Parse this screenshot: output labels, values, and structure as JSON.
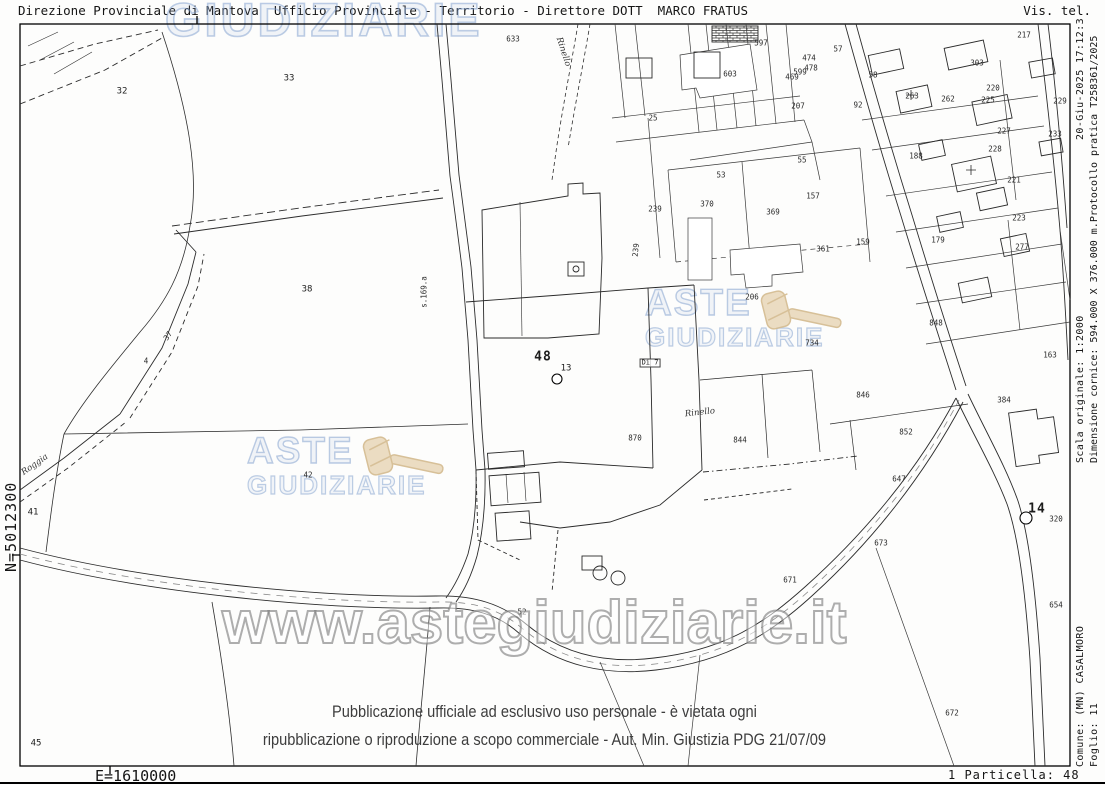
{
  "header": {
    "left": "Direzione Provinciale di Mantova  Ufficio Provinciale - Territorio - Direttore DOTT  MARCO FRATUS",
    "right": "Vis. tel."
  },
  "margins": {
    "north_coord": "N=5012300",
    "east_coord": "E=1610000",
    "particella": "1 Particella: 48",
    "timestamp": "20-Giu-2025 17:12:3",
    "scala": "Scala originale: 1:2000",
    "dimensione_protocollo": "Dimensione cornice: 594.000 X 376.000 m.Protocollo pratica T258361/2025",
    "comune": "Comune: (MN) CASALMORO",
    "foglio": "Foglio: 11"
  },
  "watermarks": {
    "top_word": "GIUDIZIARIE",
    "logo_line1": "ASTE",
    "logo_line2": "GIUDIZIARIE",
    "url": "www.astegiudiziarie.it",
    "disclaimer_line1": "Pubblicazione ufficiale ad esclusivo uso personale - è vietata ogni",
    "disclaimer_line2": "ripubblicazione o riproduzione a scopo commerciale - Aut. Min. Giustizia PDG 21/07/09",
    "brand_blue": "#80a0cd",
    "gavel_beige": "#e8d7b8"
  },
  "map": {
    "subject_parcel": "48",
    "fiducial_points": [
      "13",
      "14"
    ],
    "labels": [
      {
        "t": "32",
        "x": 122,
        "y": 92
      },
      {
        "t": "33",
        "x": 289,
        "y": 79
      },
      {
        "t": "38",
        "x": 307,
        "y": 290
      },
      {
        "t": "37",
        "x": 168,
        "y": 336,
        "r": -55,
        "s": "sm"
      },
      {
        "t": "4",
        "x": 146,
        "y": 361,
        "s": "sm"
      },
      {
        "t": "41",
        "x": 33,
        "y": 513
      },
      {
        "t": "42",
        "x": 308,
        "y": 475,
        "s": "sm"
      },
      {
        "t": "45",
        "x": 36,
        "y": 744
      },
      {
        "t": "52",
        "x": 522,
        "y": 612,
        "s": "sm"
      },
      {
        "t": "Roggia",
        "x": 35,
        "y": 465,
        "r": -35,
        "s": "it"
      },
      {
        "t": "s.169.a",
        "x": 424,
        "y": 292,
        "r": -90,
        "s": "sm"
      },
      {
        "t": "Rinello",
        "x": 563,
        "y": 52,
        "r": 72,
        "s": "it"
      },
      {
        "t": "633",
        "x": 513,
        "y": 39,
        "s": "sm"
      },
      {
        "t": "48",
        "x": 543,
        "y": 357,
        "s": "lg"
      },
      {
        "t": "13",
        "x": 566,
        "y": 369
      },
      {
        "t": "Di 7",
        "x": 650,
        "y": 363,
        "s": "bx"
      },
      {
        "t": "Rinello",
        "x": 700,
        "y": 413,
        "r": -6,
        "s": "it"
      },
      {
        "t": "239",
        "x": 655,
        "y": 209,
        "s": "sm"
      },
      {
        "t": "239",
        "x": 636,
        "y": 250,
        "r": -85,
        "s": "sm"
      },
      {
        "t": "370",
        "x": 707,
        "y": 204,
        "s": "sm"
      },
      {
        "t": "369",
        "x": 773,
        "y": 212,
        "s": "sm"
      },
      {
        "t": "206",
        "x": 752,
        "y": 297,
        "s": "sm"
      },
      {
        "t": "361",
        "x": 823,
        "y": 249,
        "s": "sm"
      },
      {
        "t": "734",
        "x": 812,
        "y": 343,
        "s": "sm"
      },
      {
        "t": "157",
        "x": 813,
        "y": 196,
        "s": "sm"
      },
      {
        "t": "159",
        "x": 863,
        "y": 242,
        "s": "sm"
      },
      {
        "t": "179",
        "x": 938,
        "y": 240,
        "s": "sm"
      },
      {
        "t": "870",
        "x": 635,
        "y": 438,
        "s": "sm"
      },
      {
        "t": "844",
        "x": 740,
        "y": 440,
        "s": "sm"
      },
      {
        "t": "846",
        "x": 863,
        "y": 395,
        "s": "sm"
      },
      {
        "t": "852",
        "x": 906,
        "y": 432,
        "s": "sm"
      },
      {
        "t": "647",
        "x": 899,
        "y": 479,
        "s": "sm"
      },
      {
        "t": "673",
        "x": 881,
        "y": 543,
        "s": "sm"
      },
      {
        "t": "671",
        "x": 790,
        "y": 580,
        "s": "sm"
      },
      {
        "t": "672",
        "x": 952,
        "y": 713,
        "s": "sm"
      },
      {
        "t": "654",
        "x": 1056,
        "y": 605,
        "s": "sm"
      },
      {
        "t": "384",
        "x": 1004,
        "y": 400,
        "s": "sm"
      },
      {
        "t": "14",
        "x": 1037,
        "y": 509,
        "s": "lg"
      },
      {
        "t": "320",
        "x": 1056,
        "y": 519,
        "s": "sm"
      },
      {
        "t": "163",
        "x": 1050,
        "y": 355,
        "s": "sm"
      },
      {
        "t": "848",
        "x": 936,
        "y": 323,
        "s": "sm"
      },
      {
        "t": "25",
        "x": 653,
        "y": 118,
        "s": "sm"
      },
      {
        "t": "53",
        "x": 721,
        "y": 175,
        "s": "sm"
      },
      {
        "t": "55",
        "x": 802,
        "y": 160,
        "s": "sm"
      },
      {
        "t": "57",
        "x": 838,
        "y": 49,
        "s": "sm"
      },
      {
        "t": "58",
        "x": 873,
        "y": 75,
        "s": "sm"
      },
      {
        "t": "92",
        "x": 858,
        "y": 105,
        "s": "sm"
      },
      {
        "t": "263",
        "x": 912,
        "y": 96,
        "s": "sm"
      },
      {
        "t": "262",
        "x": 948,
        "y": 99,
        "s": "sm"
      },
      {
        "t": "188",
        "x": 916,
        "y": 156,
        "s": "sm"
      },
      {
        "t": "228",
        "x": 995,
        "y": 149,
        "s": "sm"
      },
      {
        "t": "225",
        "x": 988,
        "y": 100,
        "s": "sm"
      },
      {
        "t": "220",
        "x": 993,
        "y": 88,
        "s": "sm"
      },
      {
        "t": "303",
        "x": 977,
        "y": 63,
        "s": "sm"
      },
      {
        "t": "207",
        "x": 798,
        "y": 106,
        "s": "sm"
      },
      {
        "t": "597",
        "x": 761,
        "y": 43,
        "s": "sm"
      },
      {
        "t": "599",
        "x": 800,
        "y": 72,
        "s": "sm"
      },
      {
        "t": "474",
        "x": 809,
        "y": 58,
        "s": "sm"
      },
      {
        "t": "478",
        "x": 811,
        "y": 68,
        "s": "sm"
      },
      {
        "t": "469",
        "x": 792,
        "y": 77,
        "s": "sm"
      },
      {
        "t": "603",
        "x": 730,
        "y": 74,
        "s": "sm"
      },
      {
        "t": "217",
        "x": 1024,
        "y": 35,
        "s": "sm"
      },
      {
        "t": "229",
        "x": 1060,
        "y": 101,
        "s": "sm"
      },
      {
        "t": "227",
        "x": 1004,
        "y": 131,
        "s": "sm"
      },
      {
        "t": "233",
        "x": 1055,
        "y": 134,
        "s": "sm"
      },
      {
        "t": "221",
        "x": 1014,
        "y": 180,
        "s": "sm"
      },
      {
        "t": "223",
        "x": 1019,
        "y": 218,
        "s": "sm"
      },
      {
        "t": "277",
        "x": 1022,
        "y": 247,
        "s": "sm"
      }
    ]
  }
}
